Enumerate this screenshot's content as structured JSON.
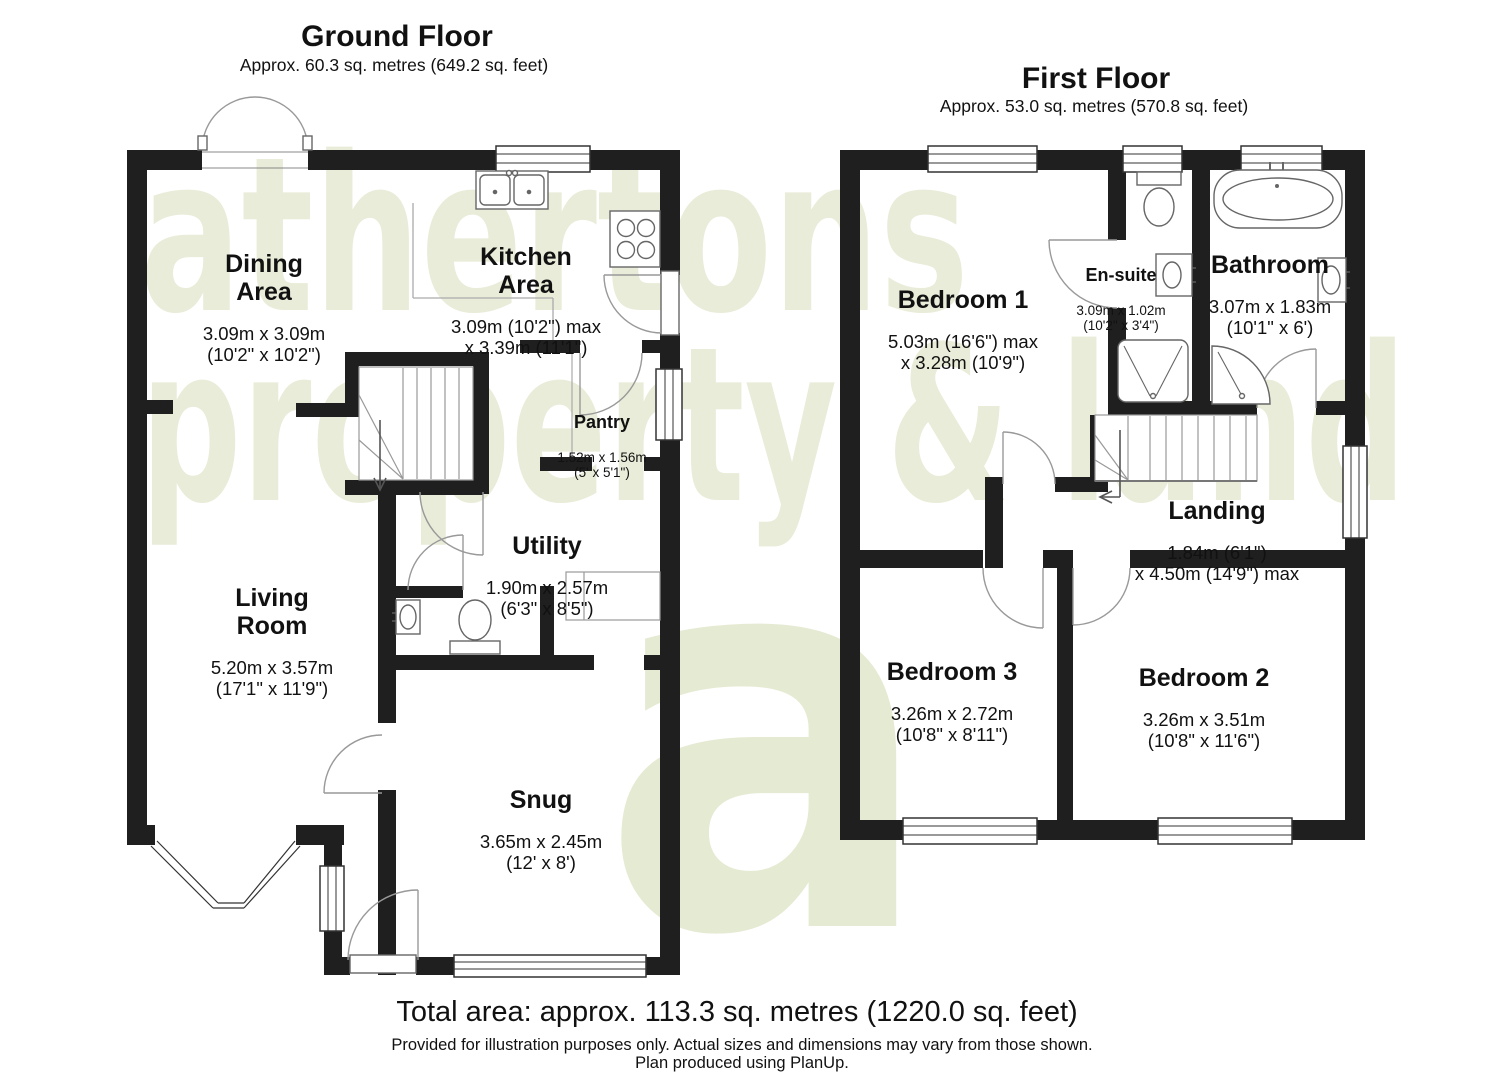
{
  "watermark": {
    "line1": "athertons",
    "line2": "property & land",
    "logo_letter": "a",
    "color": "#e9ecd8"
  },
  "ground_floor": {
    "title": "Ground Floor",
    "subtitle": "Approx. 60.3 sq. metres (649.2 sq. feet)",
    "rooms": {
      "dining": {
        "name": "Dining\nArea",
        "dims": "3.09m x 3.09m\n(10'2\" x 10'2\")"
      },
      "kitchen": {
        "name": "Kitchen\nArea",
        "dims": "3.09m (10'2\") max\nx 3.39m (11'1\")"
      },
      "pantry": {
        "name": "Pantry",
        "dims": "1.52m x 1.56m\n(5' x 5'1\")"
      },
      "utility": {
        "name": "Utility",
        "dims": "1.90m x 2.57m\n(6'3\" x 8'5\")"
      },
      "living": {
        "name": "Living\nRoom",
        "dims": "5.20m x 3.57m\n(17'1\" x 11'9\")"
      },
      "snug": {
        "name": "Snug",
        "dims": "3.65m x 2.45m\n(12' x 8')"
      }
    }
  },
  "first_floor": {
    "title": "First Floor",
    "subtitle": "Approx. 53.0 sq. metres (570.8 sq. feet)",
    "rooms": {
      "bedroom1": {
        "name": "Bedroom 1",
        "dims": "5.03m (16'6\") max\nx 3.28m (10'9\")"
      },
      "ensuite": {
        "name": "En-suite",
        "dims": "3.09m x 1.02m\n(10'2\" x 3'4\")"
      },
      "bathroom": {
        "name": "Bathroom",
        "dims": "3.07m x 1.83m\n(10'1\" x 6')"
      },
      "landing": {
        "name": "Landing",
        "dims": "1.84m (6'1\")\nx 4.50m (14'9\") max"
      },
      "bedroom3": {
        "name": "Bedroom 3",
        "dims": "3.26m x 2.72m\n(10'8\" x 8'11\")"
      },
      "bedroom2": {
        "name": "Bedroom 2",
        "dims": "3.26m x 3.51m\n(10'8\" x 11'6\")"
      }
    }
  },
  "footer": {
    "total_area": "Total area: approx. 113.3 sq. metres (1220.0 sq. feet)",
    "disclaimer": "Provided for illustration purposes only. Actual sizes and dimensions may vary from those shown.",
    "produced": "Plan produced using PlanUp."
  },
  "colors": {
    "wall": "#1f1f1f",
    "fixture_line": "#666666",
    "door_line": "#999999",
    "window_line": "#333333",
    "watermark": "#e9ecd8"
  }
}
